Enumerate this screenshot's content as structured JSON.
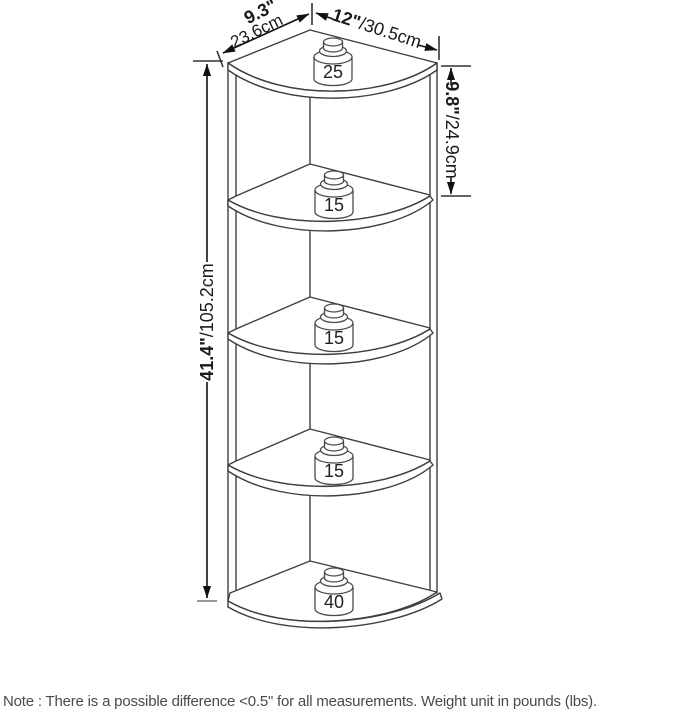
{
  "diagram": {
    "product": "5-tier corner shelf dimension drawing",
    "dimensions": {
      "depth": {
        "inches": "9.3\"",
        "cm": "23.6cm"
      },
      "width": {
        "inches": "12\"",
        "cm": "/30.5cm"
      },
      "tier_height": {
        "inches": "9.8\"",
        "cm": "/24.9cm"
      },
      "total_height": {
        "inches": "41.4\"",
        "cm": "/105.2cm"
      }
    },
    "shelf_weight_limits_lbs": [
      "25",
      "15",
      "15",
      "15",
      "40"
    ]
  },
  "note": "Note : There is a possible difference <0.5\" for all measurements. Weight unit in pounds (lbs)."
}
